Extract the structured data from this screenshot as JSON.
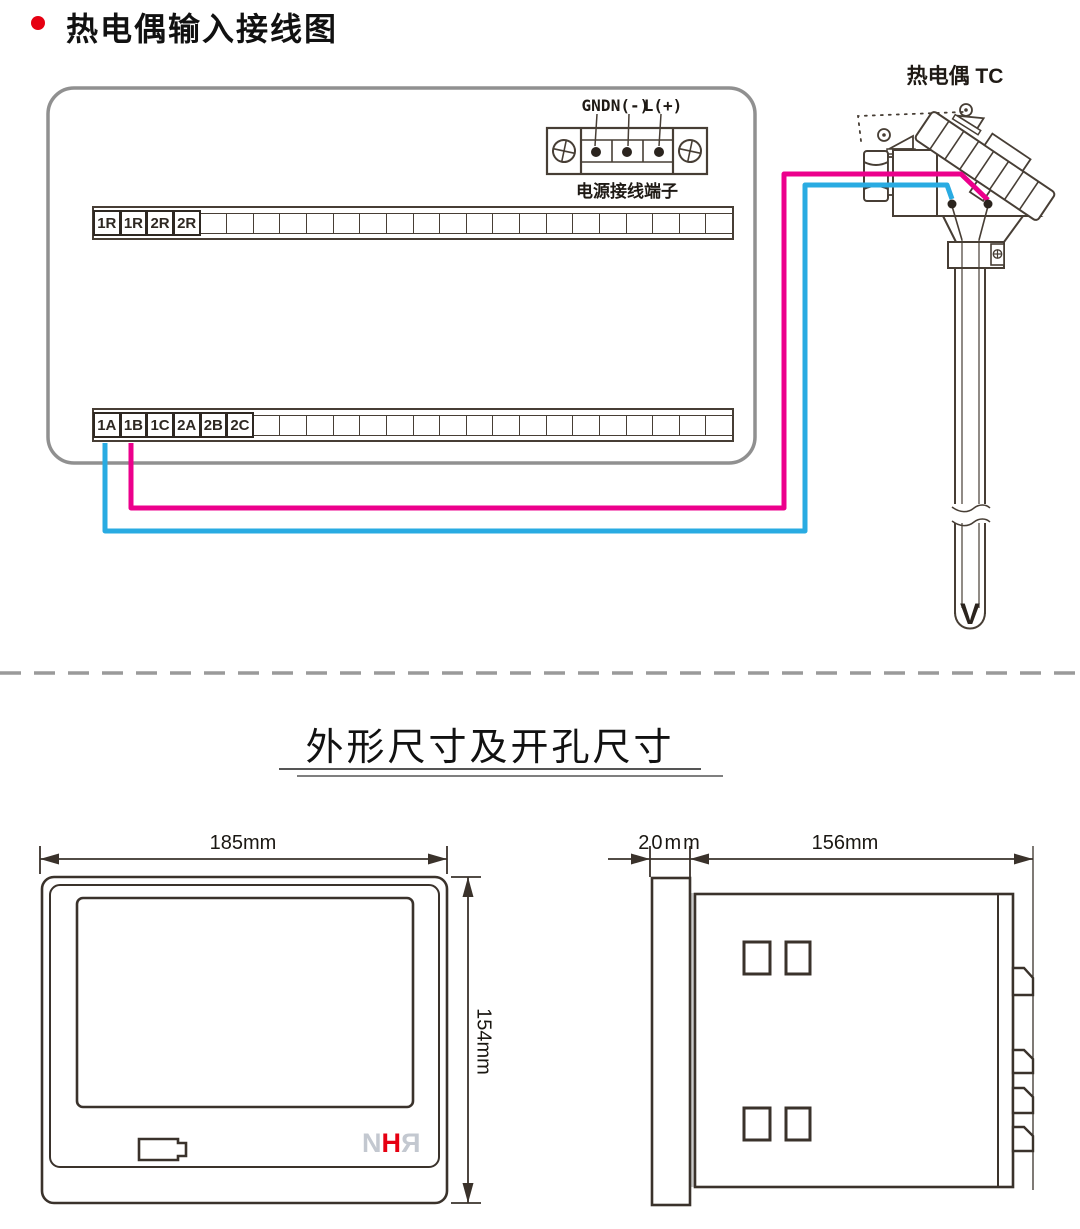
{
  "colors": {
    "wire_positive": "#ec008c",
    "wire_negative": "#29abe2",
    "accent_red": "#e60012",
    "logo_gray": "#c3c8d0",
    "line_dark": "#473e35",
    "panel_gray": "#909090"
  },
  "sections": {
    "wiring": {
      "title": "热电偶输入接线图",
      "thermocouple_label": "热电偶 TC",
      "thermocouple_tip_mark": "V",
      "power_terminal": {
        "labels": [
          "GND",
          "N(-)",
          "L(+)"
        ],
        "caption": "电源接线端子"
      },
      "top_strip": {
        "labels": [
          "1R",
          "1R",
          "2R",
          "2R"
        ]
      },
      "bottom_strip": {
        "labels": [
          "1A",
          "1B",
          "1C",
          "2A",
          "2B",
          "2C"
        ]
      }
    },
    "dimensions": {
      "title": "外形尺寸及开孔尺寸",
      "front_view": {
        "width": "185mm",
        "height": "154mm",
        "logo": {
          "n": "N",
          "h": "H",
          "r": "R"
        }
      },
      "side_view": {
        "bezel_depth": "20mm",
        "body_depth": "156mm"
      }
    }
  }
}
